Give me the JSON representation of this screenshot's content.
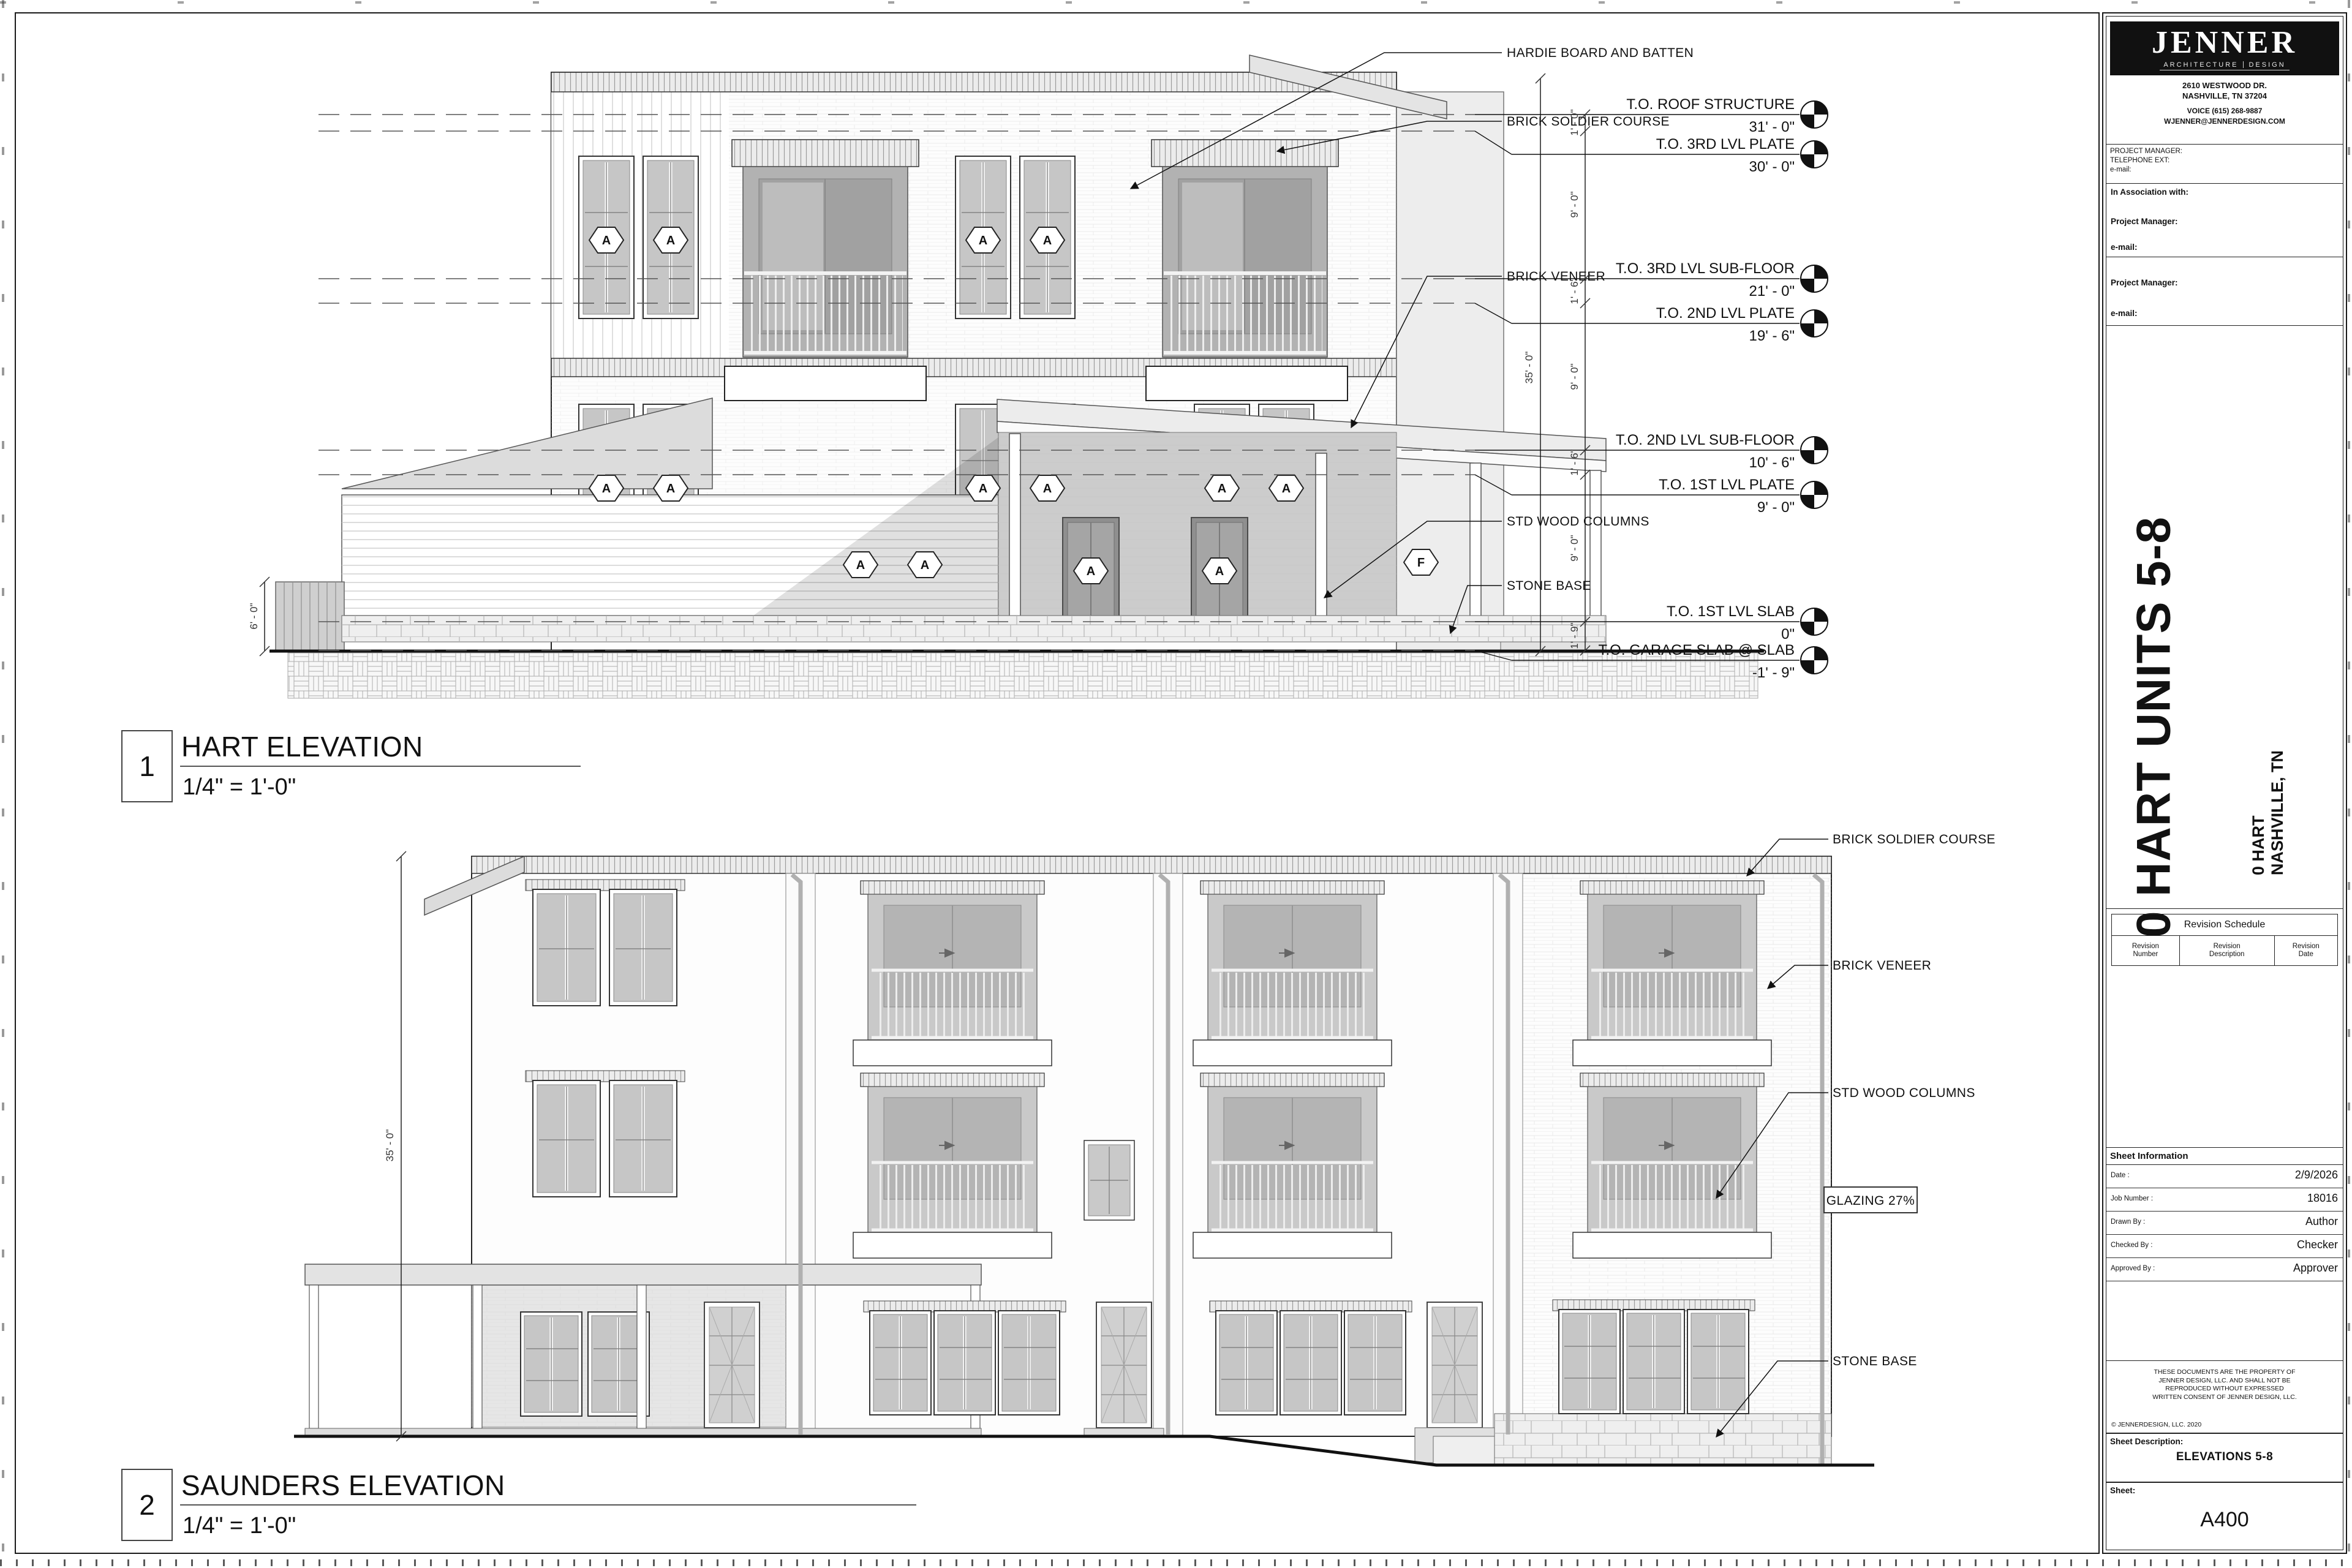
{
  "sheet": {
    "firm": {
      "name": "JENNER",
      "tagline_left": "ARCHITECTURE",
      "tagline_right": "DESIGN",
      "address_line1": "2610  WESTWOOD DR.",
      "address_line2": "NASHVILLE, TN  37204",
      "phone": "VOICE (615) 268-9887",
      "email": "WJENNER@JENNERDESIGN.COM"
    },
    "project_manager_block": {
      "line1": "PROJECT MANAGER:",
      "line2": "TELEPHONE EXT:",
      "line3": "e-mail:"
    },
    "association_block": {
      "title": "In Association with:",
      "pm_label": "Project Manager:",
      "email_label": "e-mail:"
    },
    "consultant_block": {
      "pm_label": "Project Manager:",
      "email_label": "e-mail:"
    },
    "project_title": "0 HART UNITS 5-8",
    "project_address": {
      "line1": "0 HART",
      "line2": "NASHVILLE, TN"
    },
    "revision_schedule": {
      "title": "Revision Schedule",
      "columns": [
        {
          "l1": "Revision",
          "l2": "Number"
        },
        {
          "l1": "Revision",
          "l2": "Description"
        },
        {
          "l1": "Revision",
          "l2": "Date"
        }
      ]
    },
    "sheet_information": {
      "title": "Sheet Information",
      "rows": [
        {
          "label": "Date :",
          "value": "2/9/2026"
        },
        {
          "label": "Job Number :",
          "value": "18016"
        },
        {
          "label": "Drawn By :",
          "value": "Author"
        },
        {
          "label": "Checked By :",
          "value": "Checker"
        },
        {
          "label": "Approved By :",
          "value": "Approver"
        }
      ]
    },
    "copyright": {
      "line1": "THESE DOCUMENTS ARE THE PROPERTY OF",
      "line2": "JENNER DESIGN, LLC. AND SHALL NOT BE",
      "line3": "REPRODUCED WITHOUT EXPRESSED",
      "line4": "WRITTEN CONSENT OF JENNER DESIGN, LLC.",
      "copyright_line": "© JENNERDESIGN, LLC.  2020"
    },
    "sheet_description": {
      "label": "Sheet Description:",
      "value": "ELEVATIONS 5-8"
    },
    "sheet_number": {
      "label": "Sheet:",
      "value": "A400"
    }
  },
  "elevation1": {
    "number": "1",
    "title": "HART ELEVATION",
    "scale": "1/4\" = 1'-0\"",
    "levels": [
      {
        "label": "T.O. ROOF STRUCTURE",
        "value": "31' - 0\""
      },
      {
        "label": "T.O. 3RD LVL PLATE",
        "value": "30' - 0\""
      },
      {
        "label": "T.O. 3RD LVL SUB-FLOOR",
        "value": "21' - 0\""
      },
      {
        "label": "T.O. 2ND LVL PLATE",
        "value": "19' - 6\""
      },
      {
        "label": "T.O. 2ND LVL SUB-FLOOR",
        "value": "10' - 6\""
      },
      {
        "label": "T.O. 1ST LVL PLATE",
        "value": "9' - 0\""
      },
      {
        "label": "T.O. 1ST LVL SLAB",
        "value": "0\""
      },
      {
        "label": "T.O. GARAGE SLAB @ SLAB",
        "value": "-1' - 9\""
      }
    ],
    "labels": {
      "hardie": "HARDIE BOARD AND BATTEN",
      "soldier": "BRICK SOLDIER COURSE",
      "veneer": "BRICK VENEER",
      "columns": "STD WOOD COLUMNS",
      "stone": "STONE BASE"
    },
    "dims": {
      "overall": "35' - 0\"",
      "segments": [
        "1' - 0\"",
        "9' - 0\"",
        "1' - 6\"",
        "9' - 0\"",
        "1' - 6\"",
        "9' - 0\"",
        "1' - 9\""
      ],
      "fence": "6' - 0\""
    },
    "window_tag": "A",
    "keynote_tag": "F"
  },
  "elevation2": {
    "number": "2",
    "title": "SAUNDERS ELEVATION",
    "scale": "1/4\" = 1'-0\"",
    "labels": {
      "soldier": "BRICK SOLDIER COURSE",
      "veneer": "BRICK VENEER",
      "columns": "STD WOOD COLUMNS",
      "glazing": "GLAZING 27%",
      "stone": "STONE BASE"
    },
    "dims": {
      "overall": "35' - 0\""
    }
  }
}
